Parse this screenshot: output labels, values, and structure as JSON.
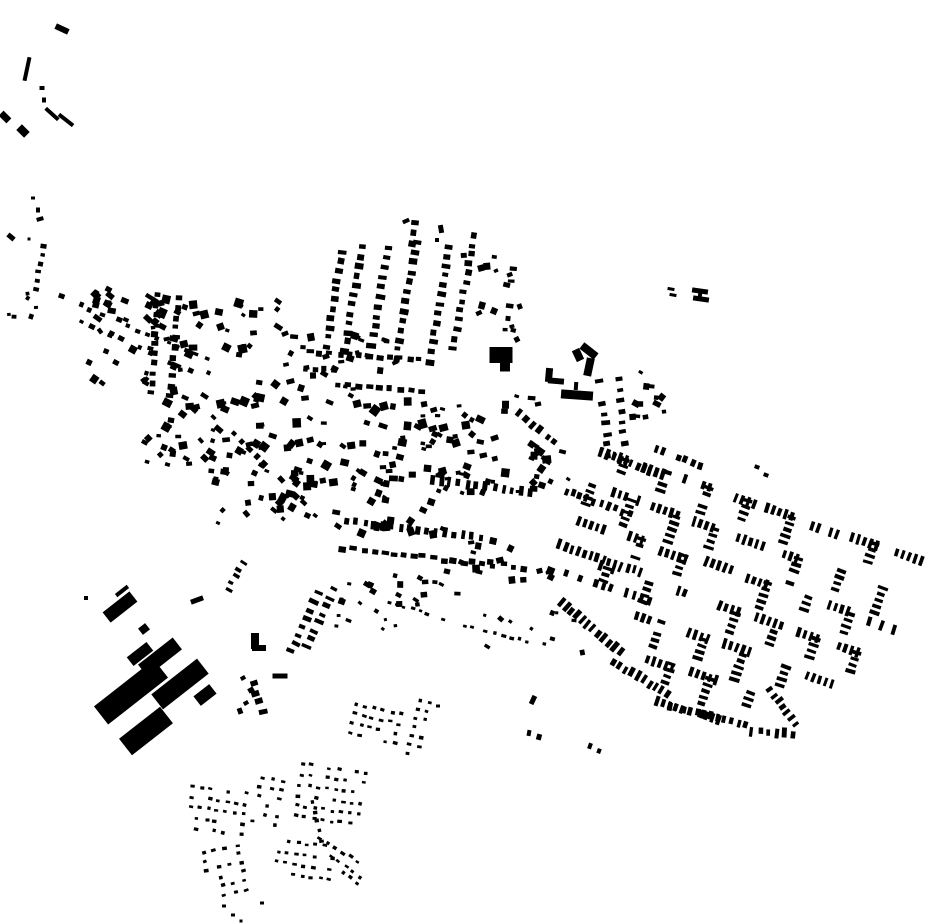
{
  "map": {
    "background": "#ffffff",
    "ink": "#000000",
    "width": 930,
    "height": 924,
    "buildings": [
      [
        62,
        29,
        14,
        6,
        25
      ],
      [
        27,
        69,
        4,
        24,
        12
      ],
      [
        42,
        88,
        5,
        4,
        0
      ],
      [
        44,
        100,
        4,
        5,
        0
      ],
      [
        52,
        114,
        17,
        4,
        42
      ],
      [
        66,
        120,
        18,
        4,
        38
      ],
      [
        5,
        117,
        11,
        7,
        45
      ],
      [
        23,
        131,
        11,
        8,
        45
      ],
      [
        33,
        198,
        4,
        3,
        0
      ],
      [
        38,
        210,
        4,
        5,
        0
      ],
      [
        40,
        219,
        7,
        4,
        -15
      ],
      [
        11,
        237,
        8,
        5,
        40
      ],
      [
        29,
        239,
        3,
        3,
        0
      ],
      [
        501,
        355,
        23,
        16,
        0
      ],
      [
        505,
        367,
        10,
        9,
        0
      ],
      [
        589,
        367,
        8,
        18,
        12
      ],
      [
        589,
        351,
        18,
        8,
        38
      ],
      [
        578,
        355,
        8,
        12,
        -25
      ],
      [
        549,
        375,
        7,
        14,
        5
      ],
      [
        556,
        381,
        16,
        6,
        5
      ],
      [
        577,
        395,
        32,
        9,
        4
      ],
      [
        576,
        386,
        4,
        8,
        4
      ],
      [
        700,
        291,
        16,
        5,
        8
      ],
      [
        701,
        299,
        16,
        5,
        8
      ],
      [
        700,
        295,
        4,
        10,
        8
      ],
      [
        671,
        289,
        7,
        3,
        10
      ],
      [
        673,
        295,
        7,
        3,
        10
      ],
      [
        255,
        641,
        8,
        16,
        0
      ],
      [
        259,
        648,
        14,
        6,
        0
      ],
      [
        280,
        676,
        15,
        5,
        0
      ],
      [
        120,
        607,
        34,
        13,
        -38
      ],
      [
        122,
        591,
        15,
        4,
        -38
      ],
      [
        144,
        629,
        9,
        8,
        -38
      ],
      [
        140,
        654,
        25,
        11,
        -38
      ],
      [
        131,
        692,
        76,
        23,
        -38
      ],
      [
        160,
        657,
        44,
        15,
        -38
      ],
      [
        180,
        684,
        58,
        19,
        -38
      ],
      [
        146,
        731,
        52,
        21,
        -38
      ],
      [
        197,
        600,
        13,
        5,
        -20
      ],
      [
        205,
        695,
        20,
        12,
        -38
      ],
      [
        86,
        598,
        4,
        4,
        0
      ],
      [
        190,
        668,
        5,
        4,
        0
      ],
      [
        198,
        676,
        5,
        4,
        0
      ],
      [
        243,
        678,
        5,
        4,
        -30
      ],
      [
        251,
        690,
        6,
        5,
        -30
      ],
      [
        246,
        703,
        5,
        4,
        -30
      ],
      [
        240,
        711,
        5,
        6,
        -20
      ],
      [
        757,
        467,
        5,
        4,
        20
      ],
      [
        766,
        475,
        5,
        4,
        20
      ],
      [
        533,
        700,
        5,
        9,
        25
      ],
      [
        529,
        733,
        4,
        6,
        10
      ],
      [
        539,
        737,
        5,
        6,
        15
      ],
      [
        590,
        746,
        4,
        6,
        20
      ],
      [
        599,
        751,
        4,
        5,
        20
      ],
      [
        406,
        221,
        7,
        4,
        -25
      ],
      [
        441,
        229,
        5,
        8,
        -10
      ],
      [
        437,
        240,
        4,
        4,
        0
      ],
      [
        224,
        906,
        4,
        3,
        0
      ],
      [
        233,
        915,
        4,
        3,
        0
      ],
      [
        262,
        903,
        4,
        3,
        0
      ],
      [
        241,
        921,
        3,
        3,
        0
      ],
      [
        438,
        706,
        4,
        3,
        0
      ]
    ],
    "rows": [
      {
        "x": 327,
        "y": 346,
        "ang": -81,
        "n": 11,
        "pitch": 9.5,
        "w": 7,
        "h": 5,
        "rot": 8,
        "seed": 1
      },
      {
        "x": 345,
        "y": 351,
        "ang": -81,
        "n": 12,
        "pitch": 9.5,
        "w": 7,
        "h": 5,
        "rot": 8,
        "seed": 2
      },
      {
        "x": 370,
        "y": 355,
        "ang": -80,
        "n": 12,
        "pitch": 9.8,
        "w": 8,
        "h": 5,
        "rot": 8,
        "seed": 3
      },
      {
        "x": 396,
        "y": 359,
        "ang": -80,
        "n": 13,
        "pitch": 9.8,
        "w": 7,
        "h": 5,
        "rot": 8,
        "seed": 4
      },
      {
        "x": 429,
        "y": 362,
        "ang": -80,
        "n": 13,
        "pitch": 9.8,
        "w": 7,
        "h": 5,
        "rot": 8,
        "seed": 5
      },
      {
        "x": 453,
        "y": 348,
        "ang": -79,
        "n": 13,
        "pitch": 9.5,
        "w": 7,
        "h": 5,
        "rot": 8,
        "seed": 6
      },
      {
        "x": 411,
        "y": 243,
        "ang": -80,
        "n": 3,
        "pitch": 10,
        "w": 7,
        "h": 5,
        "rot": 8,
        "seed": 7
      },
      {
        "x": 506,
        "y": 330,
        "ang": -83,
        "n": 8,
        "pitch": 12.5,
        "w": 6,
        "h": 4,
        "rot": 5,
        "skip": 0.25,
        "seed": 8
      },
      {
        "x": 310,
        "y": 352,
        "ang": 4,
        "n": 12,
        "pitch": 10,
        "w": 6,
        "h": 5,
        "rot": 4,
        "seed": 9
      },
      {
        "x": 338,
        "y": 384,
        "ang": 5,
        "n": 9,
        "pitch": 10.5,
        "w": 6,
        "h": 5,
        "rot": 5,
        "seed": 10
      },
      {
        "x": 305,
        "y": 368,
        "ang": 4,
        "n": 4,
        "pitch": 10,
        "w": 5,
        "h": 5,
        "rot": 4,
        "seed": 11
      },
      {
        "x": 62,
        "y": 297,
        "ang": 23,
        "n": 18,
        "pitch": 10.5,
        "w": 5,
        "h": 4,
        "rot": 23,
        "jx": 2,
        "skip": 0.15,
        "seed": 12
      },
      {
        "x": 80,
        "y": 321,
        "ang": 25,
        "n": 12,
        "pitch": 11,
        "w": 5,
        "h": 4,
        "rot": 25,
        "jx": 2,
        "skip": 0.2,
        "seed": 13
      },
      {
        "x": 36,
        "y": 290,
        "ang": -80,
        "n": 6,
        "pitch": 9,
        "w": 5,
        "h": 4,
        "rot": 10,
        "seed": 14
      },
      {
        "x": 152,
        "y": 393,
        "ang": -87,
        "n": 11,
        "pitch": 9.8,
        "w": 6,
        "h": 5,
        "rot": 5,
        "seed": 15
      },
      {
        "x": 170,
        "y": 396,
        "ang": -85,
        "n": 11,
        "pitch": 9.8,
        "w": 6,
        "h": 5,
        "rot": 5,
        "seed": 16
      },
      {
        "x": 347,
        "y": 521,
        "ang": 7,
        "n": 16,
        "pitch": 9,
        "w": 4,
        "h": 8,
        "rot": 7,
        "seed": 17
      },
      {
        "x": 344,
        "y": 549,
        "ang": 6,
        "n": 19,
        "pitch": 10,
        "w": 6,
        "h": 5,
        "rot": 6,
        "jx": 2,
        "seed": 18
      },
      {
        "x": 432,
        "y": 479,
        "ang": 8,
        "n": 12,
        "pitch": 9,
        "w": 4,
        "h": 8,
        "rot": 8,
        "seed": 19
      },
      {
        "x": 233,
        "y": 434,
        "ang": 44,
        "n": 10,
        "pitch": 11,
        "w": 6,
        "h": 5,
        "rot": 44,
        "skip": 0.1,
        "seed": 20
      },
      {
        "x": 291,
        "y": 651,
        "ang": -65,
        "n": 8,
        "pitch": 9,
        "w": 8,
        "h": 4,
        "rot": 25,
        "seed": 21
      },
      {
        "x": 307,
        "y": 647,
        "ang": -66,
        "n": 8,
        "pitch": 9,
        "w": 8,
        "h": 4,
        "rot": 25,
        "seed": 22
      },
      {
        "x": 228,
        "y": 589,
        "ang": -60,
        "n": 5,
        "pitch": 7.5,
        "w": 6,
        "h": 3,
        "rot": 30,
        "seed": 23
      },
      {
        "x": 253,
        "y": 683,
        "ang": 72,
        "n": 4,
        "pitch": 10,
        "w": 7,
        "h": 5,
        "rot": -15,
        "seed": 24
      },
      {
        "x": 389,
        "y": 602,
        "ang": 17,
        "n": 12,
        "pitch": 8,
        "w": 4,
        "h": 3,
        "rot": 17,
        "skip": 0.1,
        "seed": 25
      },
      {
        "x": 486,
        "y": 632,
        "ang": 12,
        "n": 9,
        "pitch": 8.5,
        "w": 4,
        "h": 3,
        "rot": 12,
        "skip": 0.15,
        "seed": 26
      },
      {
        "x": 601,
        "y": 453,
        "ang": 20,
        "n": 11,
        "pitch": 6.5,
        "w": 3.5,
        "h": 9,
        "rot": 20,
        "seed": 27
      },
      {
        "x": 566,
        "y": 491,
        "ang": 20,
        "n": 10,
        "pitch": 7.5,
        "w": 4,
        "h": 8,
        "rot": 20,
        "skip": 0.2,
        "seed": 28
      },
      {
        "x": 560,
        "y": 545,
        "ang": 19,
        "n": 14,
        "pitch": 6.5,
        "w": 3.5,
        "h": 9,
        "rot": 19,
        "seed": 29
      },
      {
        "x": 565,
        "y": 573,
        "ang": 19,
        "n": 12,
        "pitch": 8,
        "w": 4,
        "h": 8,
        "rot": 19,
        "skip": 0.25,
        "seed": 30
      },
      {
        "x": 561,
        "y": 602,
        "ang": 40,
        "n": 12,
        "pitch": 7,
        "w": 4,
        "h": 9,
        "rot": 40,
        "seed": 31
      },
      {
        "x": 614,
        "y": 662,
        "ang": 31,
        "n": 10,
        "pitch": 7,
        "w": 4,
        "h": 9,
        "rot": 31,
        "seed": 32
      },
      {
        "x": 670,
        "y": 706,
        "ang": 14,
        "n": 12,
        "pitch": 7,
        "w": 4,
        "h": 8,
        "rot": 14,
        "seed": 33
      },
      {
        "x": 752,
        "y": 731,
        "ang": 4,
        "n": 6,
        "pitch": 8,
        "w": 4,
        "h": 8,
        "rot": 4,
        "seed": 34
      },
      {
        "x": 770,
        "y": 690,
        "ang": 52,
        "n": 8,
        "pitch": 7,
        "w": 4,
        "h": 8,
        "rot": 52,
        "skip": 0.1,
        "seed": 35
      },
      {
        "x": 600,
        "y": 382,
        "ang": 83,
        "n": 8,
        "pitch": 10.5,
        "w": 7,
        "h": 4,
        "rot": -8,
        "skip": 0.12,
        "seed": 36
      },
      {
        "x": 618,
        "y": 380,
        "ang": 84,
        "n": 8,
        "pitch": 10.5,
        "w": 7,
        "h": 4,
        "rot": -8,
        "skip": 0.12,
        "seed": 37
      },
      {
        "x": 648,
        "y": 446,
        "ang": 20,
        "n": 8,
        "pitch": 8,
        "w": 4,
        "h": 7,
        "rot": 20,
        "skip": 0.3,
        "seed": 38
      },
      {
        "x": 518,
        "y": 412,
        "ang": 40,
        "n": 6,
        "pitch": 9.5,
        "w": 5,
        "h": 7,
        "rot": 40,
        "seed": 39
      },
      {
        "x": 320,
        "y": 838,
        "ang": 32,
        "n": 6,
        "pitch": 9,
        "w": 4,
        "h": 3,
        "rot": 32,
        "seed": 40
      },
      {
        "x": 331,
        "y": 856,
        "ang": 36,
        "n": 5,
        "pitch": 9,
        "w": 4,
        "h": 3,
        "rot": 36,
        "seed": 41
      },
      {
        "x": 343,
        "y": 872,
        "ang": 40,
        "n": 3,
        "pitch": 9,
        "w": 4,
        "h": 3,
        "rot": 40,
        "seed": 42
      },
      {
        "x": 312,
        "y": 802,
        "ang": 78,
        "n": 5,
        "pitch": 10,
        "w": 4,
        "h": 3,
        "rot": -10,
        "seed": 43
      }
    ],
    "scatters": [
      {
        "x": 95,
        "y": 288,
        "w": 75,
        "h": 32,
        "count": 20,
        "min": 4,
        "max": 9,
        "rot": 25,
        "rj": 20,
        "seed": 3
      },
      {
        "x": 88,
        "y": 330,
        "w": 60,
        "h": 55,
        "count": 12,
        "min": 4,
        "max": 8,
        "rot": 30,
        "rj": 25,
        "seed": 4
      },
      {
        "x": 150,
        "y": 300,
        "w": 130,
        "h": 75,
        "count": 38,
        "min": 4,
        "max": 9,
        "rot": 10,
        "rj": 30,
        "seed": 5
      },
      {
        "x": 165,
        "y": 372,
        "w": 120,
        "h": 85,
        "count": 40,
        "min": 4,
        "max": 9,
        "rot": 15,
        "rj": 30,
        "seed": 6
      },
      {
        "x": 280,
        "y": 330,
        "w": 120,
        "h": 70,
        "count": 28,
        "min": 4,
        "max": 8,
        "rot": 5,
        "rj": 30,
        "seed": 7
      },
      {
        "x": 285,
        "y": 400,
        "w": 140,
        "h": 85,
        "count": 45,
        "min": 4,
        "max": 9,
        "rot": 10,
        "rj": 30,
        "seed": 8
      },
      {
        "x": 420,
        "y": 395,
        "w": 130,
        "h": 80,
        "count": 38,
        "min": 4,
        "max": 9,
        "rot": 10,
        "rj": 30,
        "seed": 9
      },
      {
        "x": 210,
        "y": 455,
        "w": 110,
        "h": 70,
        "count": 30,
        "min": 4,
        "max": 8,
        "rot": 20,
        "rj": 30,
        "seed": 10
      },
      {
        "x": 300,
        "y": 470,
        "w": 150,
        "h": 65,
        "count": 35,
        "min": 4,
        "max": 8,
        "rot": 10,
        "rj": 30,
        "seed": 11
      },
      {
        "x": 440,
        "y": 450,
        "w": 120,
        "h": 45,
        "count": 20,
        "min": 4,
        "max": 8,
        "rot": 10,
        "rj": 25,
        "seed": 12
      },
      {
        "x": 340,
        "y": 570,
        "w": 120,
        "h": 35,
        "count": 18,
        "min": 4,
        "max": 7,
        "rot": 8,
        "rj": 25,
        "seed": 13
      },
      {
        "x": 455,
        "y": 540,
        "w": 100,
        "h": 40,
        "count": 16,
        "min": 4,
        "max": 8,
        "rot": 10,
        "rj": 25,
        "seed": 14
      },
      {
        "x": 462,
        "y": 250,
        "w": 70,
        "h": 90,
        "count": 14,
        "min": 4,
        "max": 7,
        "rot": 0,
        "rj": 30,
        "seed": 15
      },
      {
        "x": 622,
        "y": 368,
        "w": 45,
        "h": 50,
        "count": 12,
        "min": 4,
        "max": 8,
        "rot": 15,
        "rj": 25,
        "seed": 16
      },
      {
        "x": 480,
        "y": 612,
        "w": 110,
        "h": 55,
        "count": 10,
        "min": 3,
        "max": 6,
        "rot": 15,
        "rj": 30,
        "seed": 17
      },
      {
        "x": 5,
        "y": 292,
        "w": 35,
        "h": 30,
        "count": 6,
        "min": 3,
        "max": 6,
        "rot": 20,
        "rj": 30,
        "seed": 18
      },
      {
        "x": 140,
        "y": 420,
        "w": 80,
        "h": 45,
        "count": 14,
        "min": 4,
        "max": 8,
        "rot": 25,
        "rj": 30,
        "seed": 19
      },
      {
        "x": 330,
        "y": 580,
        "w": 70,
        "h": 50,
        "count": 10,
        "min": 3,
        "max": 6,
        "rot": 15,
        "rj": 30,
        "seed": 20
      },
      {
        "x": 525,
        "y": 440,
        "w": 45,
        "h": 45,
        "count": 8,
        "min": 3,
        "max": 7,
        "rot": 30,
        "rj": 20,
        "seed": 21
      }
    ],
    "grids": [
      {
        "x": 193,
        "y": 786,
        "uA": 8,
        "uS": 9,
        "nu": 7,
        "vA": 98,
        "vS": 10.5,
        "nv": 5,
        "w": 4,
        "h": 3,
        "rot": 8,
        "skip": 0.18,
        "seed": 1
      },
      {
        "x": 262,
        "y": 777,
        "uA": 102,
        "uS": 9,
        "nu": 6,
        "vA": 12,
        "vS": 11,
        "nv": 3,
        "w": 4,
        "h": 3,
        "rot": 12,
        "skip": 0.15,
        "seed": 2
      },
      {
        "x": 203,
        "y": 853,
        "uA": 77,
        "uS": 9,
        "nu": 6,
        "vA": -13,
        "vS": 11.5,
        "nv": 4,
        "w": 4,
        "h": 3,
        "rot": -13,
        "skip": 0.18,
        "seed": 3
      },
      {
        "x": 280,
        "y": 840,
        "uA": 8,
        "uS": 9,
        "nu": 7,
        "vA": 98,
        "vS": 11,
        "nv": 4,
        "w": 4,
        "h": 3,
        "rot": 8,
        "skip": 0.18,
        "seed": 4
      },
      {
        "x": 357,
        "y": 704,
        "uA": 13,
        "uS": 9,
        "nu": 6,
        "vA": 103,
        "vS": 10,
        "nv": 4,
        "w": 4,
        "h": 3,
        "rot": 13,
        "skip": 0.18,
        "seed": 5
      },
      {
        "x": 303,
        "y": 764,
        "uA": 8,
        "uS": 9,
        "nu": 8,
        "vA": 98,
        "vS": 10.5,
        "nv": 6,
        "w": 4,
        "h": 3,
        "rot": 8,
        "skip": 0.2,
        "seed": 6
      },
      {
        "x": 420,
        "y": 700,
        "uA": 103,
        "uS": 9,
        "nu": 7,
        "vA": 13,
        "vS": 10,
        "nv": 2,
        "w": 4,
        "h": 3,
        "rot": 13,
        "skip": 0.15,
        "seed": 7
      }
    ],
    "district": {
      "x": 603,
      "y": 452,
      "uAngle": 19,
      "du": 22,
      "vAngle": 109,
      "dv": 36,
      "vcounts": [
        4,
        4,
        4,
        4,
        5,
        6,
        7,
        7,
        7,
        6,
        6,
        5,
        5,
        4,
        4
      ],
      "combCount": 5,
      "combPitch": 6.5,
      "barLong": 9,
      "barShort": 3.5,
      "skip": 0.22,
      "seed": 9
    }
  }
}
